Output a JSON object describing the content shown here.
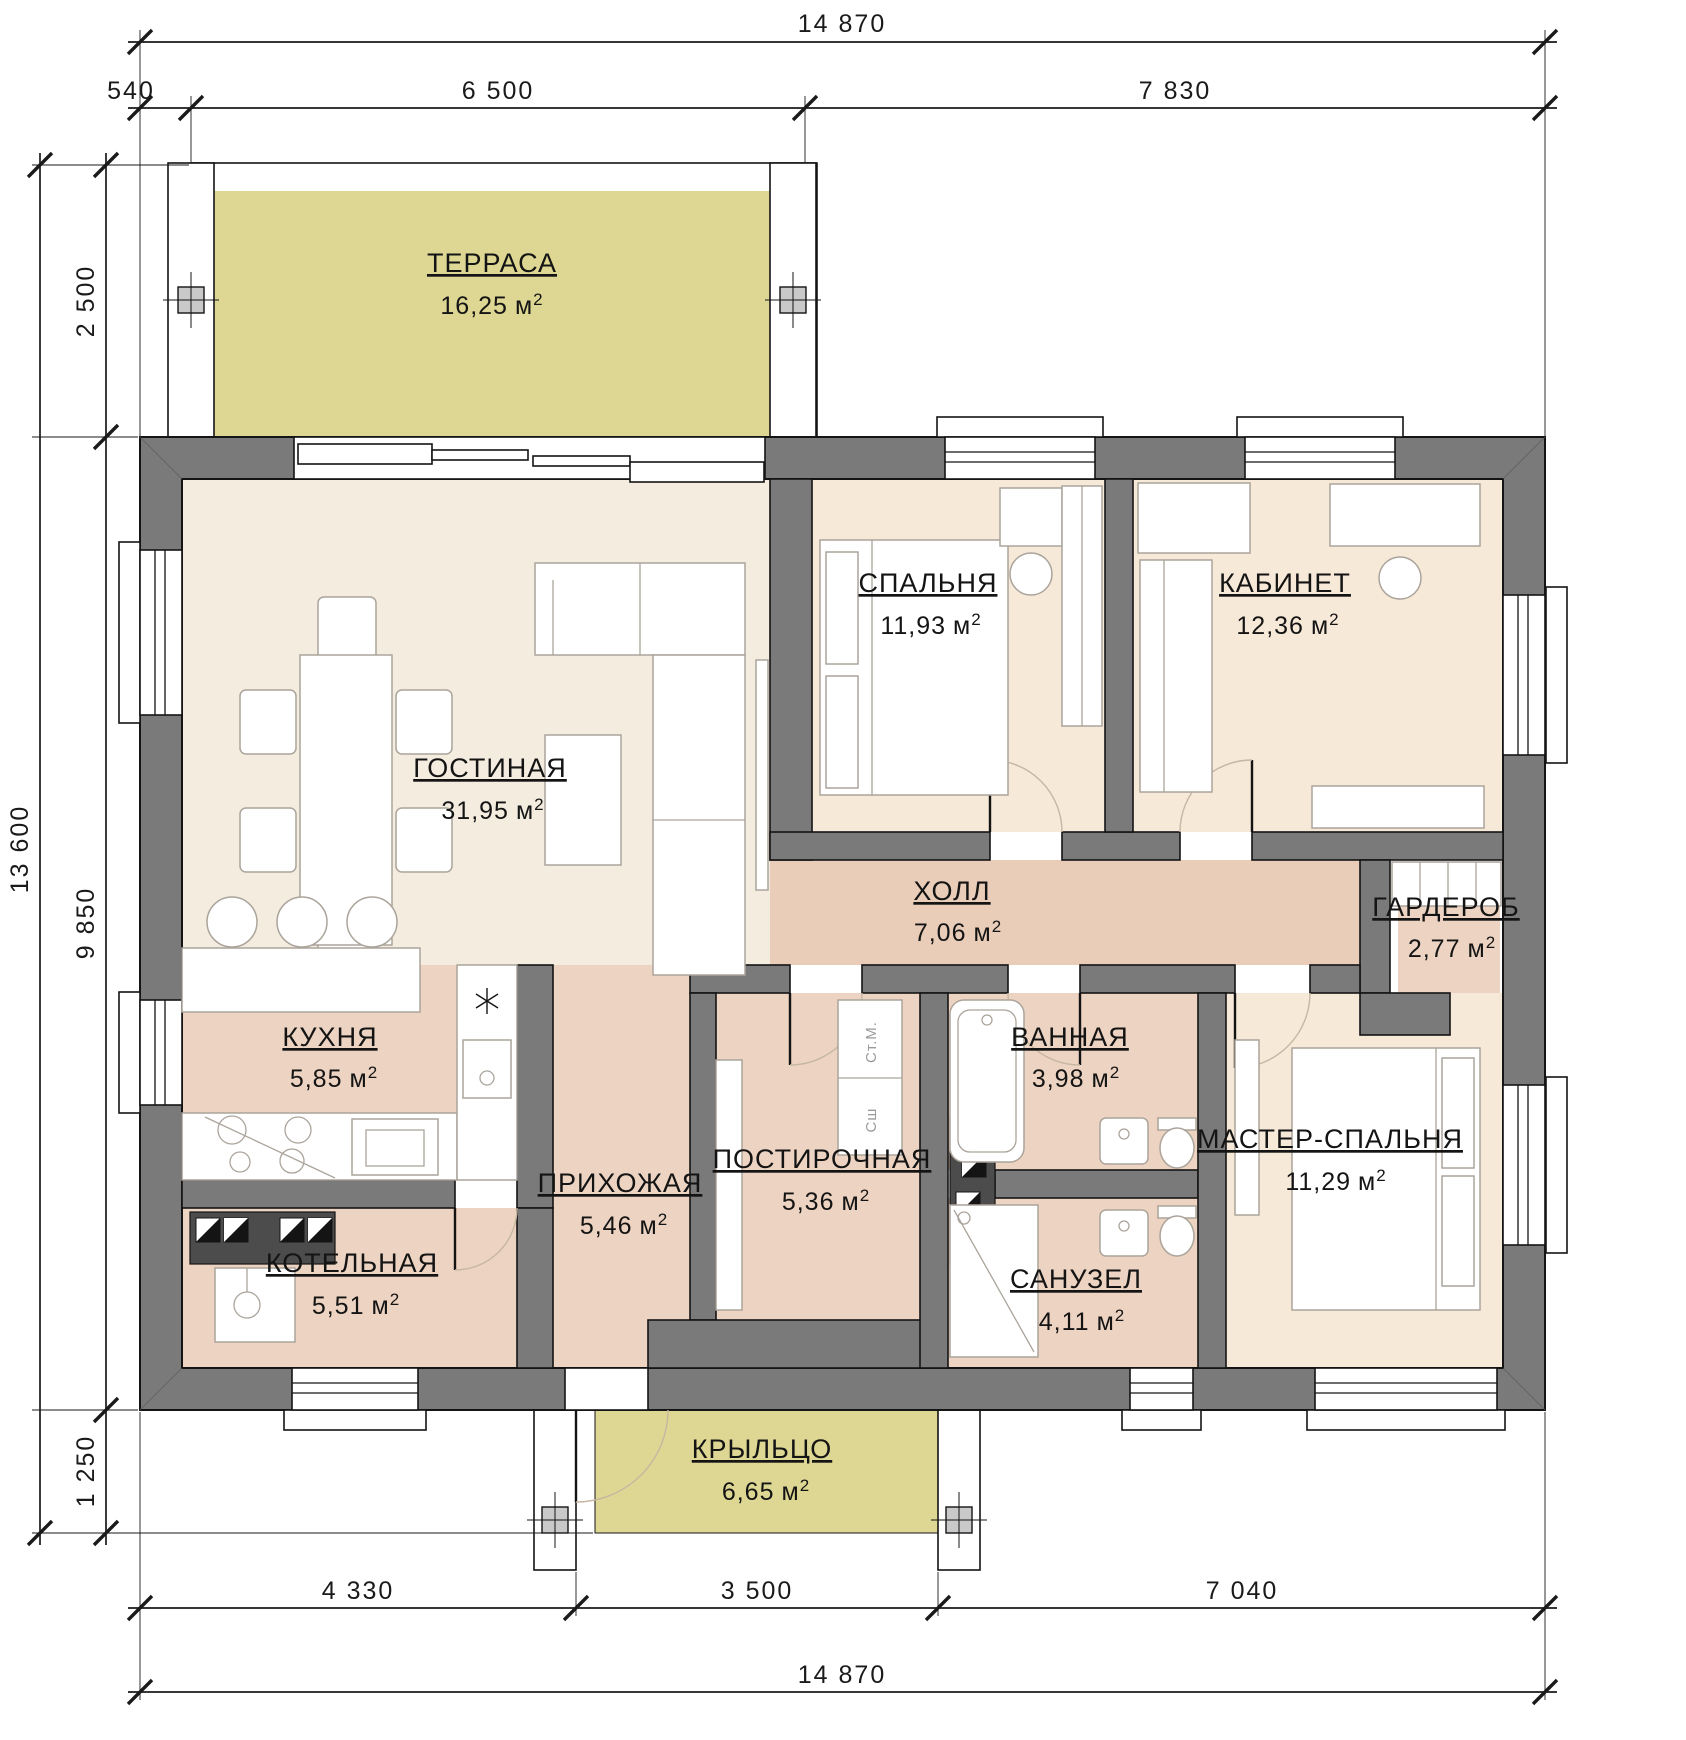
{
  "title": "floor-plan",
  "unit": {
    "base": "м",
    "sup": "2"
  },
  "rooms": [
    {
      "id": "terrace",
      "name": "ТЕРРАСА",
      "area": "16,25"
    },
    {
      "id": "living",
      "name": "ГОСТИНАЯ",
      "area": "31,95"
    },
    {
      "id": "bedroom",
      "name": "СПАЛЬНЯ",
      "area": "11,93"
    },
    {
      "id": "office",
      "name": "КАБИНЕТ",
      "area": "12,36"
    },
    {
      "id": "hall",
      "name": "ХОЛЛ",
      "area": "7,06"
    },
    {
      "id": "wardrobe",
      "name": "ГАРДЕРОБ",
      "area": "2,77"
    },
    {
      "id": "kitchen",
      "name": "КУХНЯ",
      "area": "5,85"
    },
    {
      "id": "bathroom",
      "name": "ВАННАЯ",
      "area": "3,98"
    },
    {
      "id": "laundry",
      "name": "ПОСТИРОЧНАЯ",
      "area": "5,36"
    },
    {
      "id": "entry",
      "name": "ПРИХОЖАЯ",
      "area": "5,46"
    },
    {
      "id": "master",
      "name": "МАСТЕР-СПАЛЬНЯ",
      "area": "11,29"
    },
    {
      "id": "boiler",
      "name": "КОТЕЛЬНАЯ",
      "area": "5,51"
    },
    {
      "id": "wc",
      "name": "САНУЗЕЛ",
      "area": "4,11"
    },
    {
      "id": "porch",
      "name": "КРЫЛЬЦО",
      "area": "6,65"
    }
  ],
  "appliances": {
    "washer": "Ст.М.",
    "dryer": "Сш"
  },
  "dimensions": {
    "top_total": "14 870",
    "top": [
      "540",
      "6 500",
      "7 830"
    ],
    "bottom": [
      "4 330",
      "3 500",
      "7 040"
    ],
    "bottom_total": "14 870",
    "left_total": "13 600",
    "left": [
      "2 500",
      "9 850",
      "1 250"
    ]
  },
  "colors": {
    "wall": "#7a7a7a",
    "wallDark": "#4c4c4c",
    "line": "#141414",
    "cream": "#f3ecdf",
    "creamPink": "#f6e9d8",
    "pink": "#edd3c1",
    "pinkHall": "#e9cdb9",
    "khaki": "#ddd793",
    "furn": "#aba49b",
    "dim": "#1a1a1a",
    "applText": "#9a9a9a"
  }
}
